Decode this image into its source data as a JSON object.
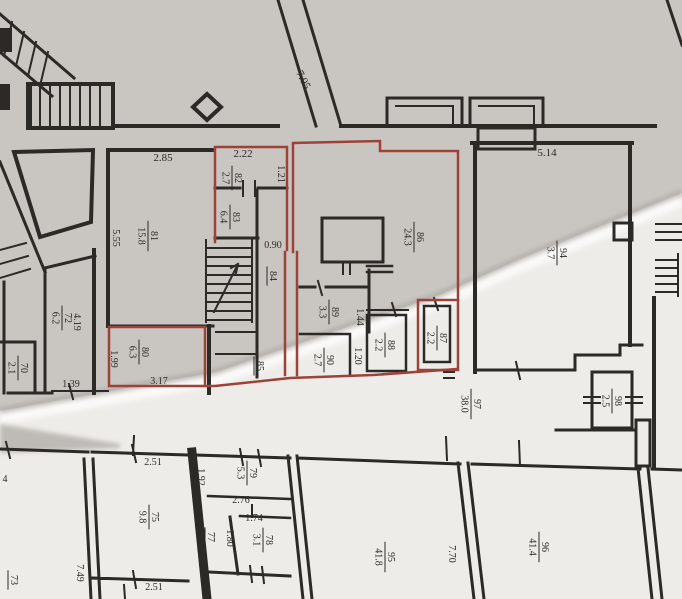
{
  "document": {
    "type": "architectural floor plan photo",
    "highlight_note": "several rooms outlined in red",
    "fold_note": "paper crease runs diagonally, upper-left area in shadow"
  },
  "colors": {
    "ink": "#2c2a27",
    "red": "#9c4238",
    "paper": "#edebe7",
    "paper_shadow": "#c9c6c2"
  },
  "rooms": [
    {
      "id": "70",
      "number": "70",
      "area": "2.1",
      "x": 19,
      "y": 368,
      "rot": 90
    },
    {
      "id": "72",
      "number": "72",
      "area": "6.2",
      "x": 63,
      "y": 318,
      "rot": 90
    },
    {
      "id": "73",
      "number": "73",
      "area": "",
      "x": 9,
      "y": 580,
      "rot": 90
    },
    {
      "id": "75",
      "number": "75",
      "area": "9.8",
      "x": 150,
      "y": 517,
      "rot": 90
    },
    {
      "id": "77",
      "number": "77",
      "area": "",
      "x": 206,
      "y": 537,
      "rot": 90
    },
    {
      "id": "78",
      "number": "78",
      "area": "3.1",
      "x": 264,
      "y": 540,
      "rot": 90
    },
    {
      "id": "79",
      "number": "79",
      "area": "5.3",
      "x": 248,
      "y": 473,
      "rot": 90
    },
    {
      "id": "80",
      "number": "80",
      "area": "6.3",
      "x": 140,
      "y": 352,
      "rot": 90
    },
    {
      "id": "81",
      "number": "81",
      "area": "15.8",
      "x": 149,
      "y": 236,
      "rot": 90
    },
    {
      "id": "82",
      "number": "82",
      "area": "2.7",
      "x": 233,
      "y": 178,
      "rot": 90
    },
    {
      "id": "83",
      "number": "83",
      "area": "6.4",
      "x": 231,
      "y": 217,
      "rot": 90
    },
    {
      "id": "84",
      "number": "84",
      "area": "",
      "x": 268,
      "y": 276,
      "rot": 90
    },
    {
      "id": "85",
      "number": "85",
      "area": "",
      "x": 255,
      "y": 366,
      "rot": 90
    },
    {
      "id": "86",
      "number": "86",
      "area": "24.3",
      "x": 415,
      "y": 237,
      "rot": 90
    },
    {
      "id": "87",
      "number": "87",
      "area": "2.2",
      "x": 438,
      "y": 338,
      "rot": 90
    },
    {
      "id": "88",
      "number": "88",
      "area": "2.2",
      "x": 386,
      "y": 345,
      "rot": 90
    },
    {
      "id": "89",
      "number": "89",
      "area": "3.3",
      "x": 330,
      "y": 312,
      "rot": 90
    },
    {
      "id": "90",
      "number": "90",
      "area": "2.7",
      "x": 325,
      "y": 360,
      "rot": 90
    },
    {
      "id": "94",
      "number": "94",
      "area": "3.7",
      "x": 558,
      "y": 253,
      "rot": 90
    },
    {
      "id": "95",
      "number": "95",
      "area": "41.8",
      "x": 386,
      "y": 557,
      "rot": 90
    },
    {
      "id": "96",
      "number": "96",
      "area": "41.4",
      "x": 540,
      "y": 547,
      "rot": 90
    },
    {
      "id": "97",
      "number": "97",
      "area": "38.0",
      "x": 472,
      "y": 404,
      "rot": 90
    },
    {
      "id": "98",
      "number": "98",
      "area": "2.5",
      "x": 613,
      "y": 401,
      "rot": 90
    }
  ],
  "dimensions": [
    {
      "text": "7.05",
      "x": 303,
      "y": 80,
      "rot": 63,
      "size": 11
    },
    {
      "text": "2.85",
      "x": 163,
      "y": 158,
      "rot": 0,
      "size": 11
    },
    {
      "text": "2.22",
      "x": 243,
      "y": 154,
      "rot": 0,
      "size": 11
    },
    {
      "text": "1.21",
      "x": 281,
      "y": 174,
      "rot": 90,
      "size": 10
    },
    {
      "text": "5.55",
      "x": 116,
      "y": 238,
      "rot": 90,
      "size": 10
    },
    {
      "text": "0.90",
      "x": 273,
      "y": 245,
      "rot": 0,
      "size": 10
    },
    {
      "text": "5.14",
      "x": 547,
      "y": 153,
      "rot": 0,
      "size": 11
    },
    {
      "text": "4.19",
      "x": 77,
      "y": 322,
      "rot": 90,
      "size": 10
    },
    {
      "text": "1.99",
      "x": 114,
      "y": 359,
      "rot": 90,
      "size": 10
    },
    {
      "text": "3.17",
      "x": 159,
      "y": 381,
      "rot": 0,
      "size": 10
    },
    {
      "text": "1.44",
      "x": 360,
      "y": 317,
      "rot": 90,
      "size": 10
    },
    {
      "text": "1.20",
      "x": 358,
      "y": 356,
      "rot": 90,
      "size": 10
    },
    {
      "text": "1.39",
      "x": 71,
      "y": 384,
      "rot": 0,
      "size": 10
    },
    {
      "text": "4",
      "x": 5,
      "y": 479,
      "rot": 0,
      "size": 10
    },
    {
      "text": "2.51",
      "x": 153,
      "y": 462,
      "rot": 0,
      "size": 10
    },
    {
      "text": "1.92",
      "x": 201,
      "y": 477,
      "rot": 90,
      "size": 10
    },
    {
      "text": "2.76",
      "x": 241,
      "y": 500,
      "rot": 0,
      "size": 10
    },
    {
      "text": "1.74",
      "x": 254,
      "y": 518,
      "rot": 0,
      "size": 10
    },
    {
      "text": "1.80",
      "x": 230,
      "y": 538,
      "rot": 90,
      "size": 10
    },
    {
      "text": "2.51",
      "x": 154,
      "y": 587,
      "rot": 0,
      "size": 10
    },
    {
      "text": "7.70",
      "x": 452,
      "y": 554,
      "rot": 90,
      "size": 10
    },
    {
      "text": "7.49",
      "x": 80,
      "y": 573,
      "rot": 90,
      "size": 10
    }
  ]
}
